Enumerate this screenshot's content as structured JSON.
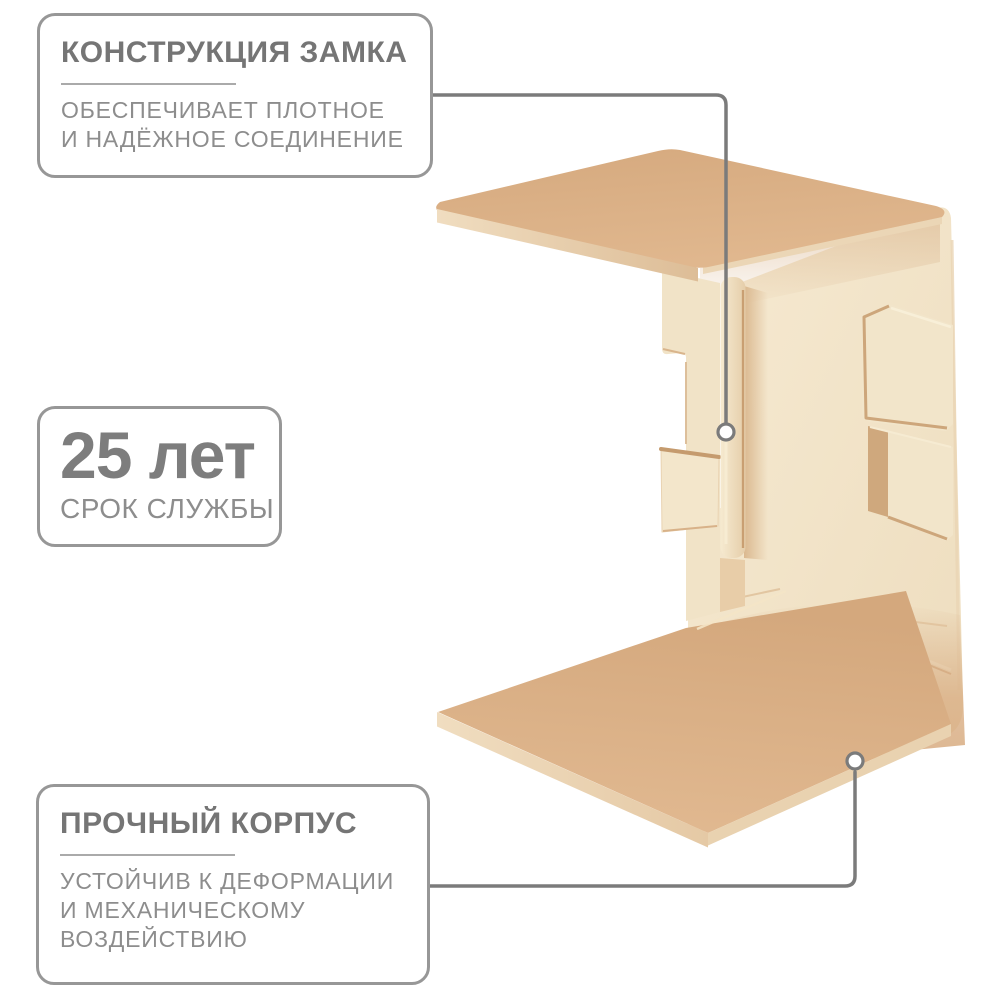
{
  "callouts": {
    "lock": {
      "title": "КОНСТРУКЦИЯ ЗАМКА",
      "line1": "ОБЕСПЕЧИВАЕТ ПЛОТНОЕ",
      "line2": "И НАДЁЖНОЕ СОЕДИНЕНИЕ"
    },
    "lifespan": {
      "value": "25 лет",
      "label": "СРОК СЛУЖБЫ"
    },
    "durable": {
      "title": "ПРОЧНЫЙ КОРПУС",
      "line1": "УСТОЙЧИВ К ДЕФОРМАЦИИ",
      "line2": "И МЕХАНИЧЕСКОМУ",
      "line3": "ВОЗДЕЙСТВИЮ"
    }
  },
  "colors": {
    "background": "#ffffff",
    "box_border": "#979797",
    "text_heading": "#757575",
    "text_body": "#8d8d8d",
    "divider": "#aaaaaa",
    "connector_line": "#7b7b7b",
    "product_plate_tan": "#dcb189",
    "product_face_cream": "#f2e4c9",
    "product_edge_light": "#eedaba",
    "product_crease_shadow": "#cda67b"
  }
}
